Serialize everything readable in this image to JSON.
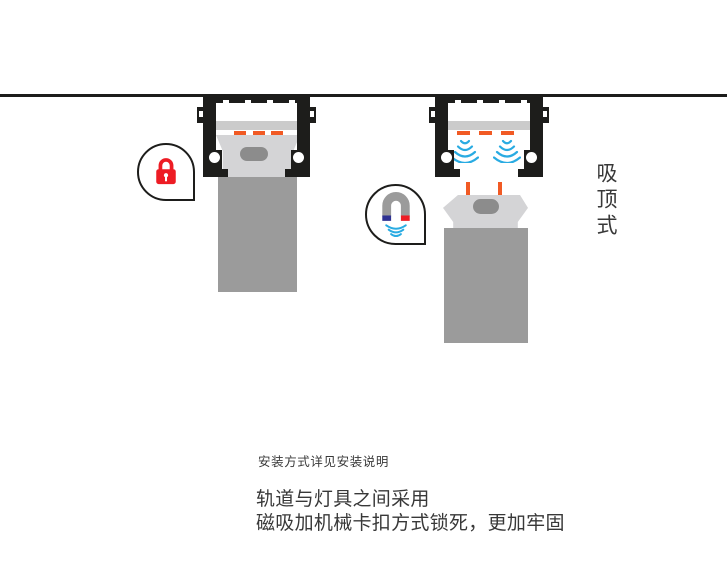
{
  "canvas": {
    "width": 727,
    "height": 585,
    "background": "#ffffff"
  },
  "colors": {
    "bg": "#ffffff",
    "track_black": "#1d1d1b",
    "strip_gray": "#cbcbcb",
    "lamp_head_gray": "#d4d4d6",
    "lamp_body_gray": "#9b9b9b",
    "knob_gray": "#8c8c8c",
    "orange": "#f15a24",
    "wave_blue": "#29abe2",
    "lock_red": "#ed1c24",
    "magnet_gray": "#9b9b9b",
    "magnet_blue": "#2e3192",
    "magnet_red": "#ed1c24",
    "text": "#383838"
  },
  "labels": {
    "mount_type": "吸顶式",
    "install_note": "安装方式详见安装说明",
    "desc_line1": "轨道与灯具之间采用",
    "desc_line2": "磁吸加机械卡扣方式锁死，更加牢固"
  },
  "icons": {
    "lock": "lock-icon",
    "magnet": "magnet-icon",
    "waves": "magnetic-field-waves"
  },
  "figures": [
    {
      "id": "installed-fixture",
      "callout_icon": "lock-icon"
    },
    {
      "id": "detached-fixture",
      "callout_icon": "magnet-icon"
    }
  ]
}
